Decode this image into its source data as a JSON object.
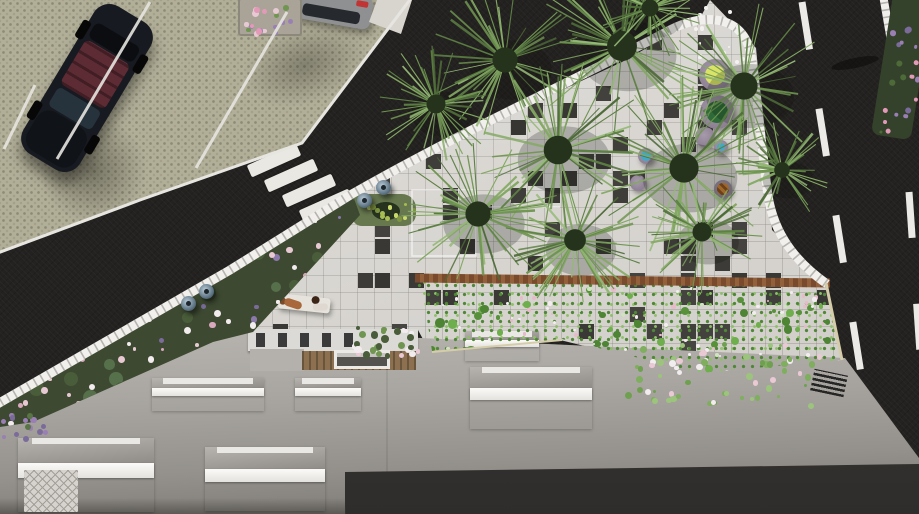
{
  "meta": {
    "caption": "Aerial top-down 3D architectural rendering of a building roof with skylights, a tiled plaza with fan palms, a lawn hedge with flowers, a parking lot with cars, a diagonal road with a zebra crosswalk and a vertical road with dashed lane markings."
  },
  "palette": {
    "asphalt": "#242220",
    "parking": "#b2af99",
    "plaza_tile": "#d9d6d1",
    "dark_tile": "#3d3a36",
    "lawn": "#7ab255",
    "roof": "#c9c6c1",
    "facade_dark": "#3a3836",
    "curb_white": "#f1f0ec",
    "wood_border": "#7a4a2c",
    "palm_green": "#5d8044",
    "flower_pink": "#e8c9d3",
    "flower_purple": "#7b6b9b"
  },
  "scene": {
    "crosswalk": {
      "count": 8,
      "x": 194,
      "y": 108,
      "stepx": 17.5,
      "stepy": 15.2,
      "angle": -24
    },
    "dark_tiles": {
      "x0": 238,
      "y0": 0,
      "x1": 845,
      "y1": 375,
      "grid": 17,
      "probability": 0.17
    },
    "stall_lines": [
      {
        "x1": 35,
        "y1": 85,
        "x2": 4,
        "y2": 149
      },
      {
        "x1": 150,
        "y1": 2,
        "x2": 57,
        "y2": 159
      },
      {
        "x1": 287,
        "y1": 12,
        "x2": 196,
        "y2": 168
      }
    ],
    "road_dashes": [
      {
        "x1": 802,
        "y1": 2,
        "x2": 876,
        "y2": 468,
        "dash": "48 60"
      },
      {
        "x1": 909,
        "y1": 192,
        "x2": 928,
        "y2": 470,
        "dash": "46 66"
      }
    ],
    "palms": [
      {
        "cx": 505,
        "cy": 60,
        "r": 74
      },
      {
        "cx": 622,
        "cy": 46,
        "r": 88
      },
      {
        "cx": 744,
        "cy": 86,
        "r": 80
      },
      {
        "cx": 558,
        "cy": 150,
        "r": 84
      },
      {
        "cx": 684,
        "cy": 168,
        "r": 86
      },
      {
        "cx": 478,
        "cy": 214,
        "r": 74
      },
      {
        "cx": 575,
        "cy": 240,
        "r": 64
      },
      {
        "cx": 702,
        "cy": 232,
        "r": 56
      },
      {
        "cx": 436,
        "cy": 104,
        "r": 56
      },
      {
        "cx": 650,
        "cy": 8,
        "r": 50
      },
      {
        "cx": 782,
        "cy": 170,
        "r": 46
      }
    ],
    "skylights": [
      {
        "x": 152,
        "y": 378,
        "w": 112,
        "h": 33,
        "type": "small"
      },
      {
        "x": 295,
        "y": 378,
        "w": 66,
        "h": 33,
        "type": "small"
      },
      {
        "x": 465,
        "y": 331,
        "w": 74,
        "h": 30,
        "type": "small"
      },
      {
        "x": 18,
        "y": 438,
        "w": 136,
        "h": 74,
        "type": "large"
      },
      {
        "x": 205,
        "y": 447,
        "w": 120,
        "h": 64,
        "type": "large"
      },
      {
        "x": 470,
        "y": 367,
        "w": 122,
        "h": 62,
        "type": "large"
      }
    ],
    "round_planters": [
      {
        "cx": 715,
        "cy": 75,
        "r": 16,
        "top": "#d9e366"
      },
      {
        "cx": 717,
        "cy": 112,
        "r": 17,
        "top": "#2e6b38"
      },
      {
        "cx": 705,
        "cy": 137,
        "r": 10,
        "top": ""
      },
      {
        "cx": 721,
        "cy": 147,
        "r": 7,
        "top": "#3fa9c9"
      },
      {
        "cx": 646,
        "cy": 156,
        "r": 8,
        "top": "#3fa9c9"
      },
      {
        "cx": 638,
        "cy": 183,
        "r": 8,
        "top": ""
      },
      {
        "cx": 723,
        "cy": 189,
        "r": 9,
        "top": "stripe"
      }
    ],
    "lamps": [
      {
        "x": 357,
        "y": 193
      },
      {
        "x": 376,
        "y": 180
      },
      {
        "x": 181,
        "y": 296
      },
      {
        "x": 199,
        "y": 284
      }
    ],
    "flower_fields": [
      {
        "target": "bedleft-dots",
        "x": 0,
        "y": 0,
        "w": 430,
        "h": 245,
        "n": 46,
        "rmin": 4,
        "rmax": 8,
        "colors": [
          "#4a5d3a",
          "#55704a",
          "#31402a"
        ]
      },
      {
        "target": "bedleft-dots",
        "x": 0,
        "y": 0,
        "w": 430,
        "h": 245,
        "n": 150,
        "rmin": 1.5,
        "rmax": 3.6,
        "colors": [
          "#e8c9d3",
          "#f2ecee",
          "#e8c9d3",
          "#7b6b9b",
          "#8b79ab",
          "#5a7544",
          "#f2ecee",
          "#d8a8bc"
        ]
      },
      {
        "target": "lawn-dots",
        "x": 10,
        "y": 12,
        "w": 415,
        "h": 90,
        "n": 48,
        "rmin": 2,
        "rmax": 5,
        "colors": [
          "#57923b",
          "#4d8534",
          "#6fae4c"
        ]
      },
      {
        "target": "lawn-dots",
        "x": 10,
        "y": 12,
        "w": 415,
        "h": 90,
        "n": 90,
        "rmin": 1,
        "rmax": 2.3,
        "colors": [
          "#f3edf1",
          "#e8b9ca",
          "#f3edf1",
          "#cfe3c0"
        ]
      },
      {
        "target": "spill-dots",
        "x": 0,
        "y": 0,
        "w": 200,
        "h": 62,
        "n": 62,
        "rmin": 1.5,
        "rmax": 3.6,
        "colors": [
          "#9cc47c",
          "#7fae5e",
          "#e9c9d4",
          "#f1ecee",
          "#6fa050"
        ]
      },
      {
        "target": "cyflowers-dots",
        "x": 0,
        "y": 0,
        "w": 66,
        "h": 28,
        "n": 28,
        "rmin": 2,
        "rmax": 4,
        "colors": [
          "#e9c9d4",
          "#f2ecee",
          "#6f9551",
          "#4a5d3a"
        ]
      },
      {
        "target": "cornerfoliage-dots",
        "x": 2,
        "y": 2,
        "w": 36,
        "h": 138,
        "n": 22,
        "rmin": 1.5,
        "rmax": 3,
        "colors": [
          "#7b6b9b",
          "#9a7fb5",
          "#e39ab8",
          "#4d6a38"
        ]
      },
      {
        "target": "parkplanter-dots",
        "x": 3,
        "y": 3,
        "w": 56,
        "h": 30,
        "n": 20,
        "rmin": 2,
        "rmax": 3.6,
        "colors": [
          "#9a7fb5",
          "#e39ab8",
          "#6f9551",
          "#e8c9d3"
        ]
      },
      {
        "target": "lampbed-dots",
        "x": 4,
        "y": 4,
        "w": 56,
        "h": 24,
        "n": 12,
        "rmin": 1.5,
        "rmax": 3,
        "colors": [
          "#c9d96a",
          "#a8bb52",
          "#7e9440"
        ]
      },
      {
        "target": "whitespecks-dots",
        "x": 0,
        "y": 0,
        "w": 60,
        "h": 56,
        "n": 14,
        "rmin": 1,
        "rmax": 2.2,
        "colors": [
          "#f4f2f0"
        ]
      },
      {
        "target": "purplecorner-dots",
        "x": 0,
        "y": 0,
        "w": 44,
        "h": 24,
        "n": 16,
        "rmin": 2,
        "rmax": 3.4,
        "colors": [
          "#7b6b9b",
          "#9a7fb5",
          "#5a7544"
        ]
      }
    ]
  }
}
